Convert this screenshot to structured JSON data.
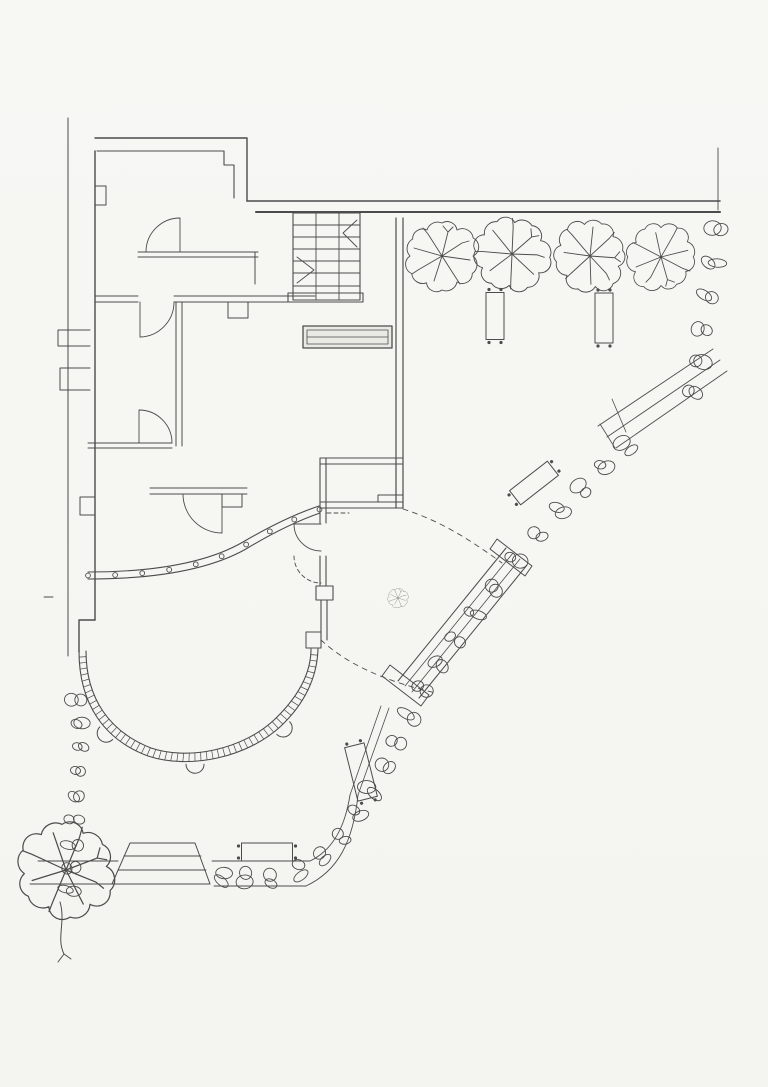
{
  "meta": {
    "description": "Scanned architectural site and ground-floor plan; pencil/ink linework, no text labels visible",
    "text_labels": []
  },
  "palette": {
    "paper": "#f6f6f3",
    "ink": "#4c4c4c",
    "ink_soft": "#6b6b6b"
  },
  "trees": [
    {
      "x": 442,
      "y": 256,
      "s": 1.0,
      "rot": 0
    },
    {
      "x": 512,
      "y": 254,
      "s": 1.05,
      "rot": 35
    },
    {
      "x": 590,
      "y": 256,
      "s": 1.0,
      "rot": 80
    },
    {
      "x": 661,
      "y": 257,
      "s": 0.95,
      "rot": 150
    },
    {
      "x": 66,
      "y": 870,
      "s": 1.35,
      "rot": 55
    }
  ],
  "shrub_marker": {
    "x": 398,
    "y": 598,
    "s": 0.28,
    "rot": 10
  },
  "benches": [
    {
      "x": 495,
      "y": 316,
      "w": 18,
      "h": 47,
      "rot": 0
    },
    {
      "x": 604,
      "y": 318,
      "w": 18,
      "h": 50,
      "rot": 0
    },
    {
      "x": 534,
      "y": 483,
      "w": 18,
      "h": 48,
      "rot": 52
    },
    {
      "x": 361,
      "y": 772,
      "w": 20,
      "h": 55,
      "rot": -14
    },
    {
      "x": 267,
      "y": 852,
      "w": 51,
      "h": 18,
      "rot": 0
    }
  ],
  "rock_chains": [
    {
      "name": "east-edge-rocks",
      "size": 9,
      "points": [
        [
          716,
          228
        ],
        [
          712,
          262
        ],
        [
          707,
          296
        ],
        [
          703,
          330
        ],
        [
          699,
          362
        ],
        [
          693,
          393
        ]
      ]
    },
    {
      "name": "southeast-and-south-rock-band",
      "size": 9,
      "points": [
        [
          626,
          446
        ],
        [
          604,
          466
        ],
        [
          582,
          488
        ],
        [
          560,
          510
        ],
        [
          538,
          534
        ],
        [
          516,
          560
        ],
        [
          494,
          588
        ],
        [
          474,
          614
        ],
        [
          456,
          640
        ],
        [
          440,
          664
        ],
        [
          424,
          690
        ],
        [
          410,
          716
        ],
        [
          397,
          742
        ],
        [
          384,
          766
        ],
        [
          371,
          790
        ],
        [
          357,
          814
        ],
        [
          342,
          838
        ],
        [
          323,
          857
        ],
        [
          299,
          871
        ],
        [
          271,
          879
        ],
        [
          244,
          879
        ],
        [
          223,
          876
        ]
      ]
    },
    {
      "name": "west-edge-rocks",
      "size": 8,
      "points": [
        [
          76,
          700
        ],
        [
          79,
          724
        ],
        [
          81,
          748
        ],
        [
          79,
          772
        ],
        [
          77,
          796
        ],
        [
          75,
          820
        ],
        [
          73,
          844
        ],
        [
          71,
          868
        ],
        [
          70,
          890
        ]
      ]
    }
  ],
  "terrace": {
    "hatch_step": 6,
    "mullion_step": 27,
    "bump_fractions": [
      0.24,
      0.5,
      0.76
    ]
  },
  "paths": {
    "site-boundary": [
      {
        "d": "M68,118 V656",
        "w": 1
      },
      {
        "d": "M90,330 H58 V346 H90",
        "w": 1
      },
      {
        "d": "M90,368 H60 V390 H90",
        "w": 1
      },
      {
        "d": "M247,201 H720",
        "w": 1.6
      },
      {
        "d": "M256,212 H720",
        "w": 2
      },
      {
        "d": "M718,148 V210",
        "w": 0.9
      },
      {
        "d": "M44,597 h9",
        "w": 0.9
      }
    ],
    "building-walls": [
      {
        "d": "M95,138 H247 V201",
        "w": 1.4
      },
      {
        "d": "M97,151 H224 V165 H234 V198",
        "w": 1.1
      },
      {
        "d": "M95,151 V620",
        "w": 1.4
      },
      {
        "d": "M95,186 H106 V205 H95",
        "w": 1
      },
      {
        "d": "M95,497 H80 V515 H95",
        "w": 1
      },
      {
        "d": "M95,620 H79 V652",
        "w": 1.4
      },
      {
        "d": "M396,218 V508",
        "w": 1.2
      },
      {
        "d": "M403,218 V508",
        "w": 1.2
      },
      {
        "d": "M288,293 H363 M288,302 H363 M288,293 V302 M363,293 V302",
        "w": 1.1
      }
    ],
    "interior-walls": [
      {
        "d": "M138,252 H258 M138,257 H258 M255,252 V284",
        "w": 1
      },
      {
        "d": "M95,296 H138 M95,302 H138 M174,296 H315 M174,302 H315",
        "w": 1
      },
      {
        "d": "M176,302 V446 M182,302 V446",
        "w": 1
      },
      {
        "d": "M88,443 H172 M88,448 H172",
        "w": 1
      },
      {
        "d": "M150,488 H247 M150,494 H247",
        "w": 1
      },
      {
        "d": "M228,302 h20 v16 h-20 Z",
        "w": 1
      },
      {
        "d": "M222,494 h20 v13 h-20 Z",
        "w": 1
      },
      {
        "d": "M320,458 H403 M320,464 H403 M320,458 V508 M326,458 V508 M320,502 H403 M320,508 H403",
        "w": 1.1
      },
      {
        "d": "M378,495 H403 M378,495 V502",
        "w": 1
      },
      {
        "d": "M320,508 V523 M326,508 V523 M320,556 V586 M326,556 V586",
        "w": 1.1
      },
      {
        "d": "M316,586 h17 v14 h-17 Z",
        "w": 1.1
      },
      {
        "d": "M321,600 V648 M327,600 V640",
        "w": 1.1
      },
      {
        "d": "M306,632 h15 v16 h-15 Z",
        "w": 1
      }
    ],
    "casework": [
      {
        "d": "M303,326 h89 v22 h-89 Z",
        "w": 1.3,
        "fill": "#eaeae5"
      },
      {
        "d": "M307,330 h81 v14 h-81 Z",
        "w": 0.8
      },
      {
        "d": "M307,337 h81",
        "w": 0.8
      }
    ],
    "stair": [
      {
        "d": "M293,213 h67 v87 h-67 Z",
        "w": 1.1
      },
      {
        "d": "M316,213 V300 M339,213 V300",
        "w": 0.9
      },
      {
        "d": "M293,225 H360 M293,237 H360 M293,249 H360 M293,261 H360 M293,273 H360 M293,286 H360",
        "w": 0.9
      },
      {
        "d": "M357,220 L343,233 L357,247",
        "w": 0.9
      },
      {
        "d": "M297,257 L314,270 L297,283",
        "w": 0.9
      }
    ],
    "doors": [
      {
        "d": "M180,252 V218 M180,218 A34,34 0 0 0 146,252",
        "w": 0.9
      },
      {
        "d": "M140,302 V337 M140,337 A35,35 0 0 0 174,302",
        "w": 0.9
      },
      {
        "d": "M172,443 A33,33 0 0 0 139,410 M139,410 V443",
        "w": 0.9
      },
      {
        "d": "M222,494 V533 M222,533 A39,39 0 0 1 183,494",
        "w": 0.9
      },
      {
        "d": "M321,524 H294 M294,524 A27,27 0 0 0 321,551",
        "w": 0.9
      },
      {
        "d": "M294,556 A27,27 0 0 0 321,583",
        "w": 0.9,
        "dash": "4 3"
      }
    ],
    "glass-wall": [
      {
        "d": "M88,572 C150,572 205,564 243,542 C272,525 298,513 319,506",
        "w": 1.1,
        "id": "glassO"
      },
      {
        "d": "M88,579 C150,579 207,571 246,549 C274,532 300,520 320,513",
        "w": 1.1,
        "id": "glassI"
      }
    ],
    "terrace-curve": [
      {
        "d": "M79,651 C79,705 105,740 148,756 C190,770 248,757 281,726 C303,705 317,679 318,649",
        "w": 1.1,
        "id": "terrO"
      },
      {
        "d": "M86,651 C86,699 110,732 151,748 C189,761 243,749 274,720 C294,701 311,677 311,649",
        "w": 1.1,
        "id": "terrI"
      }
    ],
    "upper-path": [
      {
        "d": "M713,349 L598,426",
        "w": 0.9
      },
      {
        "d": "M720,360 L607,437",
        "w": 0.9
      },
      {
        "d": "M727,371 L616,448",
        "w": 0.9
      },
      {
        "d": "M612,399 L626,432 M600,424 L615,448",
        "w": 0.8
      }
    ],
    "ramp": [
      {
        "d": "M506,548 L398,681",
        "w": 1
      },
      {
        "d": "M513,553 L405,686",
        "w": 0.8
      },
      {
        "d": "M520,559 L412,692",
        "w": 0.8
      },
      {
        "d": "M527,565 L419,698",
        "w": 1
      },
      {
        "d": "M497,539 L532,566 L525,576 L490,549 Z",
        "w": 1
      },
      {
        "d": "M390,665 L429,695 L421,706 L382,676 Z",
        "w": 1
      }
    ],
    "bottom-walkway": [
      {
        "d": "M130,843 H195 L210,884 H112 Z",
        "w": 1
      },
      {
        "d": "M124,856 H201 M118,870 H206",
        "w": 0.9
      },
      {
        "d": "M38,861 H118 M30,884 H112",
        "w": 0.9
      },
      {
        "d": "M212,861 H310 M214,886 H306",
        "w": 0.9
      },
      {
        "d": "M310,861 C333,850 345,827 350,795 M306,886 C338,871 353,842 358,795",
        "w": 0.9
      },
      {
        "d": "M350,795 L381,706 M358,795 L389,708",
        "w": 0.8
      }
    ],
    "tree-trunk": [
      {
        "d": "M60,902 C66,922 56,938 64,954 M64,954 l-6,8 M64,954 l7,5",
        "w": 1
      }
    ],
    "dashed-paths": [
      {
        "d": "M403,509 C438,520 468,538 502,563",
        "w": 0.9,
        "dash": "5 5"
      },
      {
        "d": "M327,513 H349",
        "w": 0.9,
        "dash": "4 3"
      },
      {
        "d": "M321,640 C347,664 384,681 436,693",
        "w": 0.9,
        "dash": "5 5"
      }
    ]
  }
}
